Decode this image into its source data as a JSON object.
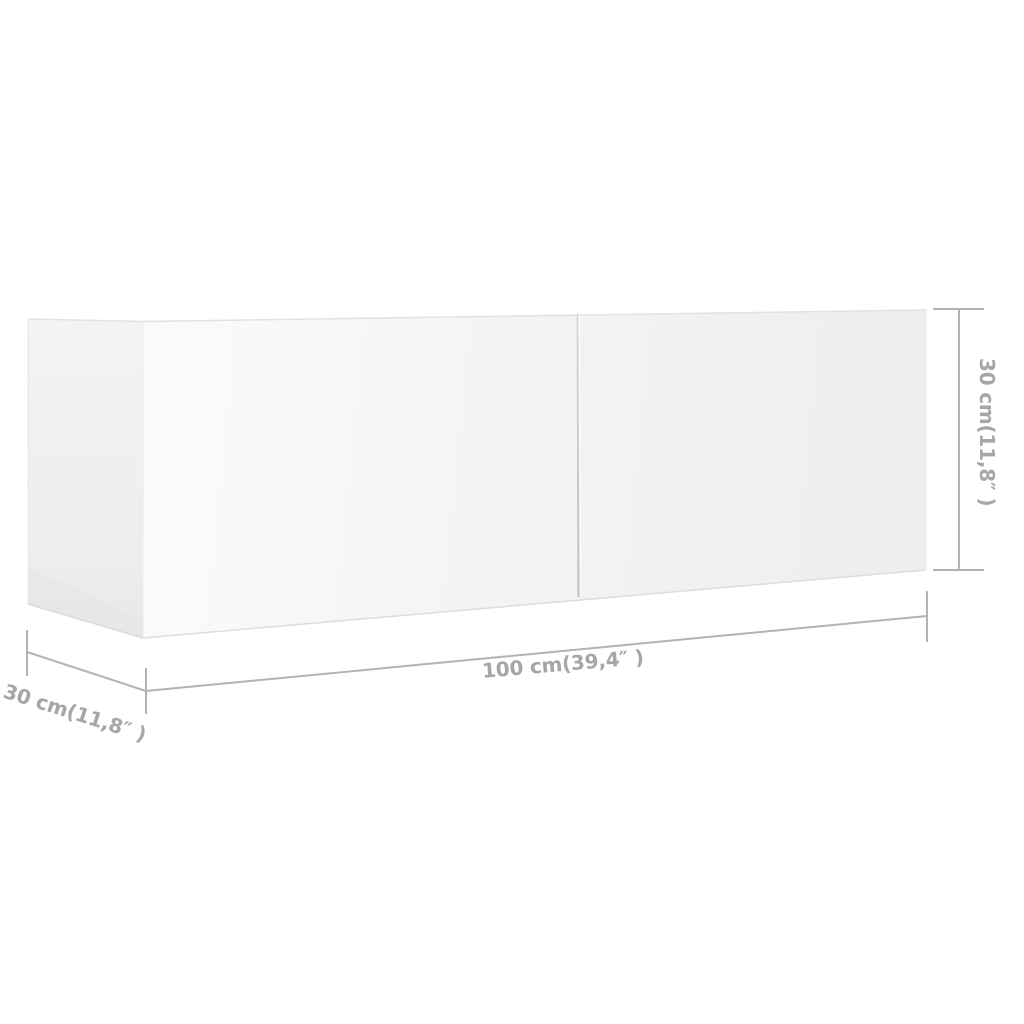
{
  "diagram": {
    "type": "product-dimension-diagram",
    "product": "wall-mounted TV cabinet, two front panels",
    "dimensions": {
      "width": {
        "label": "100 cm(39,4″ )",
        "cm": 100,
        "inches": 39.4
      },
      "depth": {
        "label": "30 cm(11,8″ )",
        "cm": 30,
        "inches": 11.8
      },
      "height": {
        "label": "30 cm(11,8″ )",
        "cm": 30,
        "inches": 11.8
      }
    },
    "colors": {
      "background": "#ffffff",
      "dimension_line": "#b2b4b4",
      "label_text": "#a5a6a6",
      "cabinet_face_light": "#fbfbfb",
      "cabinet_face_dark": "#edeeee",
      "cabinet_side_panel": "#eceded",
      "door_gap_line": "#c3c5c5"
    }
  }
}
